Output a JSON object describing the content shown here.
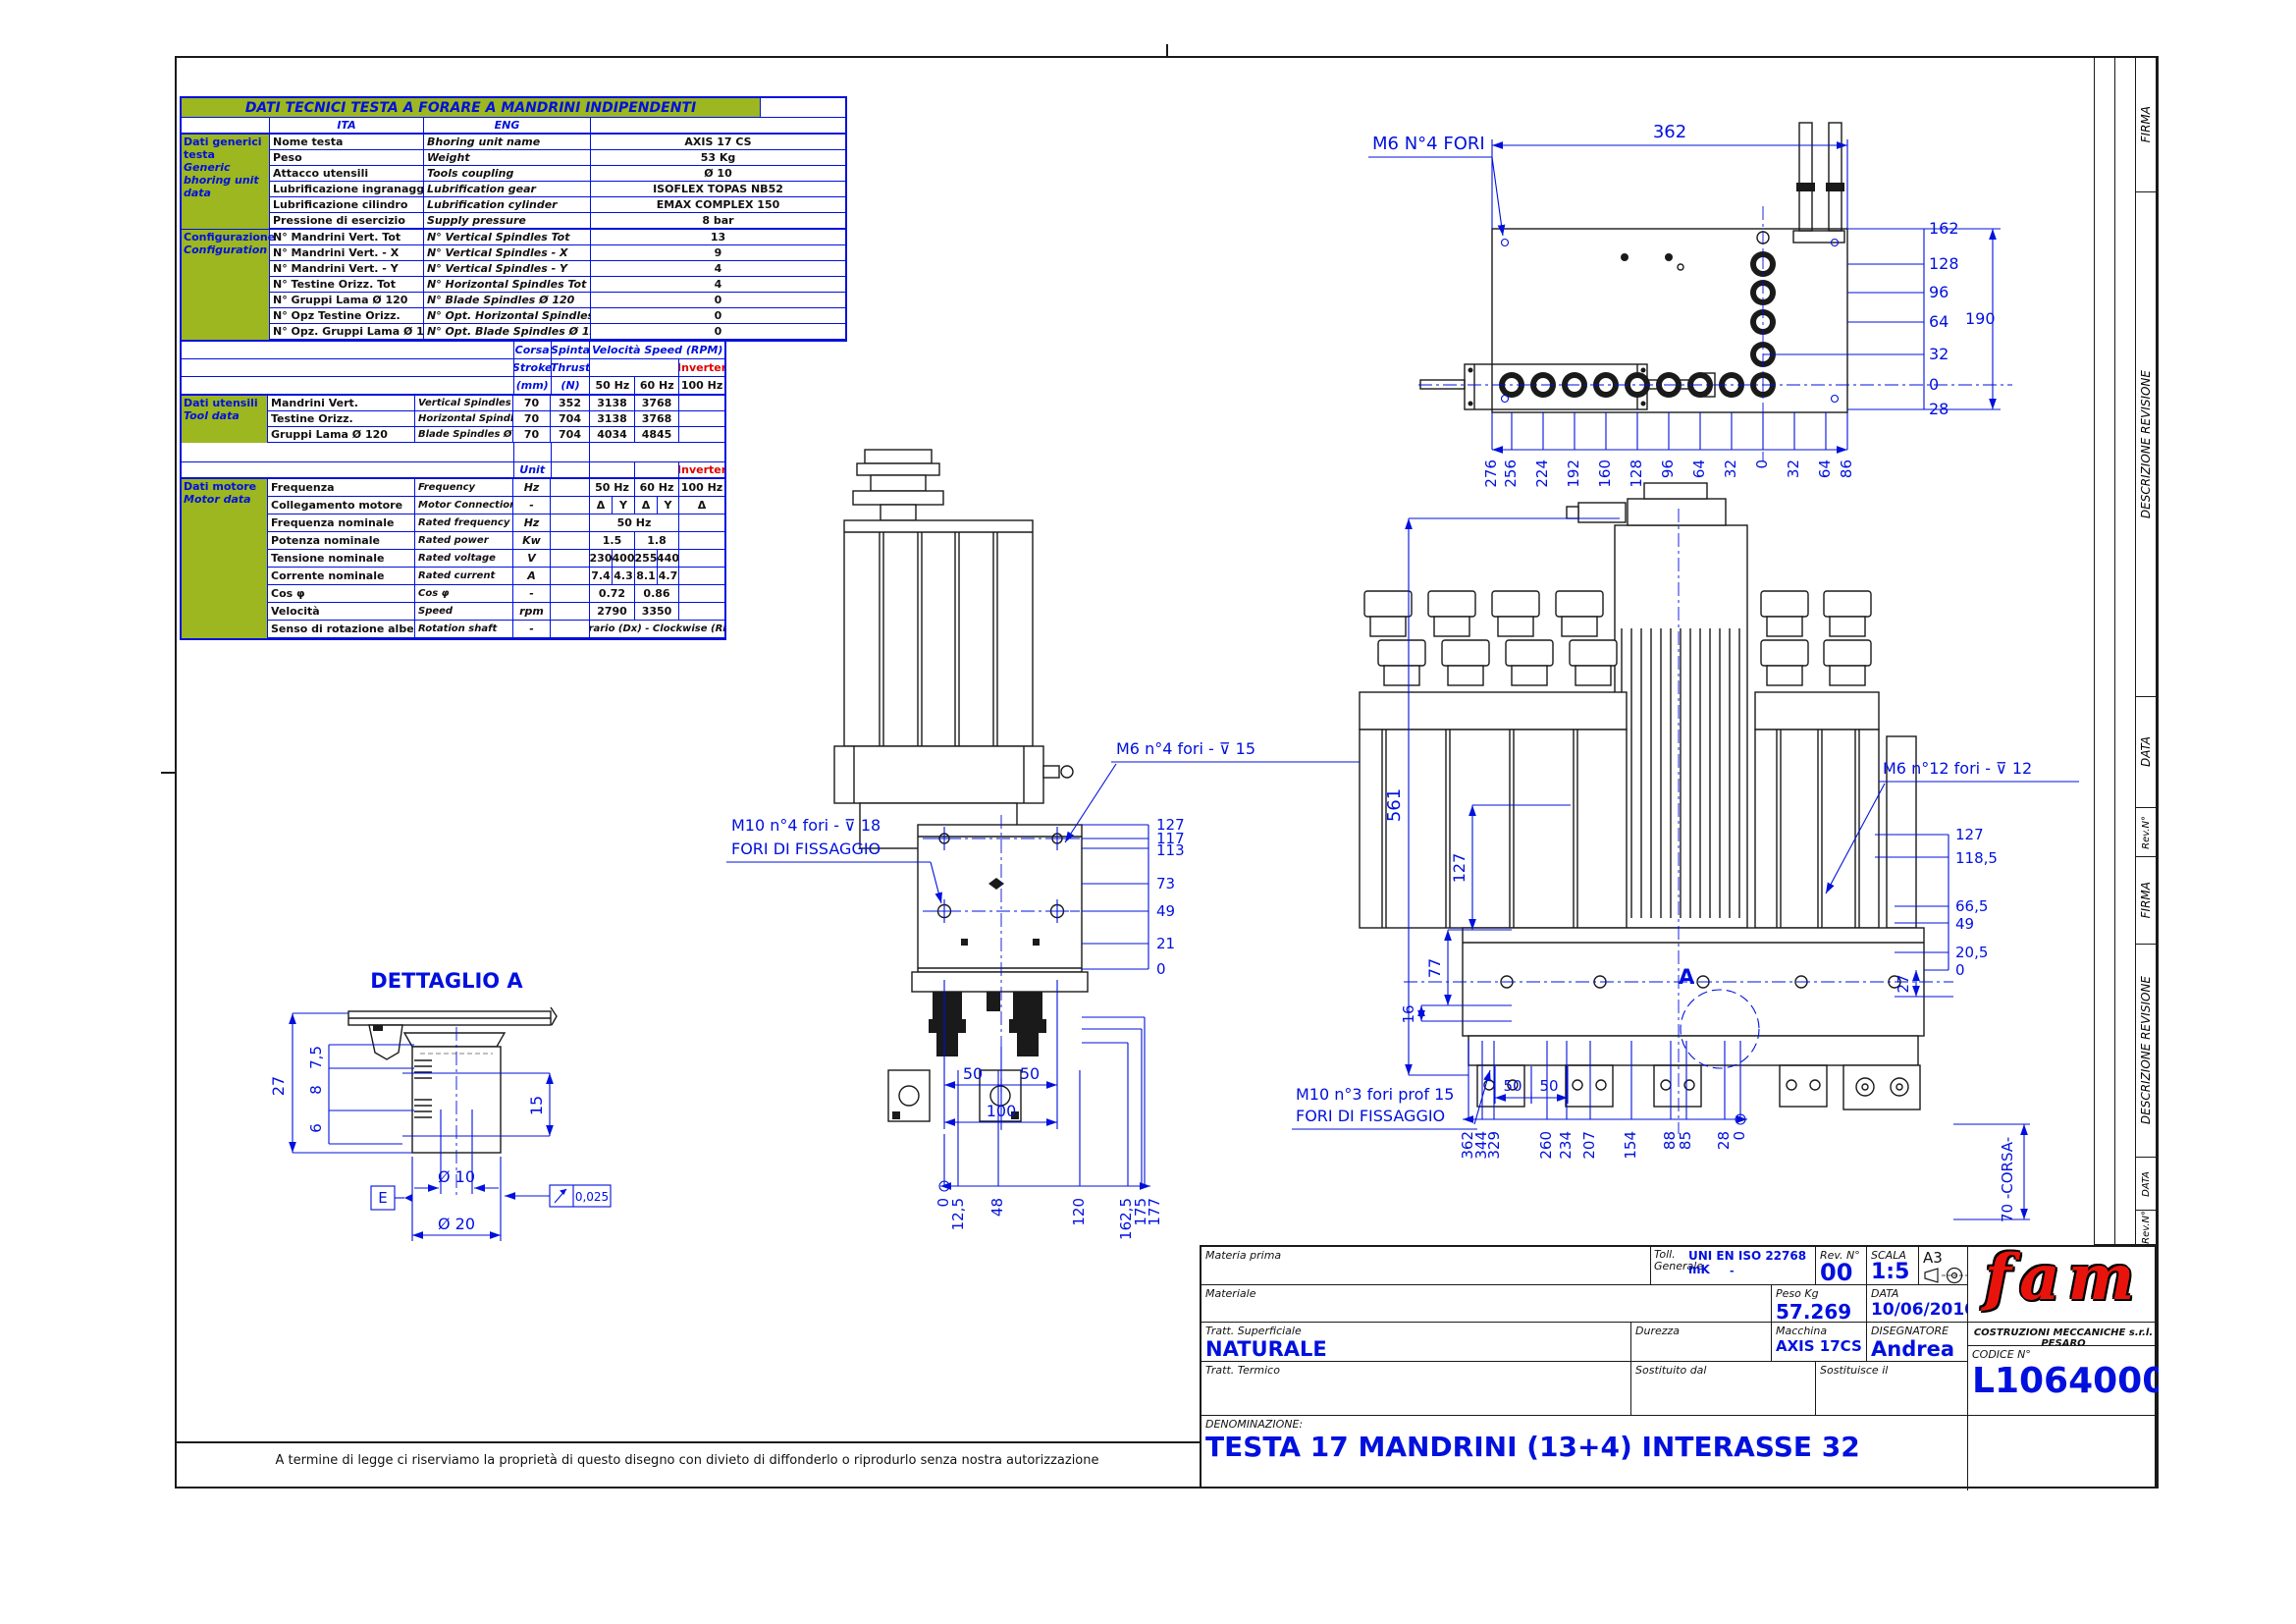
{
  "colors": {
    "line_blue": "#0010dd",
    "table_green": "#9cb71f",
    "logo_red": "#e8140c",
    "black": "#1a1a1a"
  },
  "table": {
    "title": "DATI TECNICI TESTA A FORARE A MANDRINI INDIPENDENTI",
    "col_ita": "ITA",
    "col_eng": "ENG",
    "generic": {
      "group_lines": [
        "Dati generici",
        "testa",
        "Generic",
        "bhoring unit",
        "data"
      ],
      "rows": [
        {
          "ita": "Nome testa",
          "eng": "Bhoring unit name",
          "value": "AXIS 17 CS"
        },
        {
          "ita": "Peso",
          "eng": "Weight",
          "value": "53 Kg"
        },
        {
          "ita": "Attacco utensili",
          "eng": "Tools coupling",
          "value": "Ø 10"
        },
        {
          "ita": "Lubrificazione ingranaggi",
          "eng": "Lubrification gear",
          "value": "ISOFLEX TOPAS NB52"
        },
        {
          "ita": "Lubrificazione cilindro",
          "eng": "Lubrification cylinder",
          "value": "EMAX COMPLEX 150"
        },
        {
          "ita": "Pressione di esercizio",
          "eng": "Supply pressure",
          "value": "8 bar"
        }
      ]
    },
    "configuration": {
      "group_lines": [
        "Configurazione",
        "Configuration"
      ],
      "rows": [
        {
          "ita": "N° Mandrini Vert. Tot",
          "eng": "N° Vertical Spindles Tot",
          "value": "13"
        },
        {
          "ita": "N° Mandrini Vert. - X",
          "eng": "N° Vertical Spindles - X",
          "value": "9"
        },
        {
          "ita": "N° Mandrini Vert. - Y",
          "eng": "N° Vertical Spindles - Y",
          "value": "4"
        },
        {
          "ita": "N° Testine Orizz. Tot",
          "eng": "N° Horizontal Spindles Tot",
          "value": "4"
        },
        {
          "ita": "N° Gruppi Lama Ø 120",
          "eng": "N° Blade Spindles Ø 120",
          "value": "0"
        },
        {
          "ita": "N° Opz Testine Orizz.",
          "eng": "N° Opt. Horizontal Spindles",
          "value": "0"
        },
        {
          "ita": "N° Opz. Gruppi Lama Ø 120",
          "eng": "N° Opt. Blade Spindles Ø 120",
          "value": "0"
        }
      ]
    },
    "speed_header": {
      "corsa": "Corsa",
      "stroke": "Stroke",
      "mm": "(mm)",
      "spinta": "Spinta",
      "thrust": "Thrust",
      "n": "(N)",
      "velocita": "Velocità Speed   (RPM)",
      "inverter": "Inverter",
      "hz50": "50 Hz",
      "hz60": "60 Hz",
      "hz100": "100 Hz"
    },
    "tool": {
      "group_lines": [
        "Dati utensili",
        "Tool data"
      ],
      "rows": [
        {
          "ita": "Mandrini Vert.",
          "eng": "Vertical Spindles",
          "corsa": "70",
          "spinta": "352",
          "hz50": "3138",
          "hz60": "3768",
          "inv": ""
        },
        {
          "ita": "Testine Orizz.",
          "eng": "Horizontal Spindles",
          "corsa": "70",
          "spinta": "704",
          "hz50": "3138",
          "hz60": "3768",
          "inv": ""
        },
        {
          "ita": "Gruppi Lama Ø 120",
          "eng": "Blade Spindles Ø 120",
          "corsa": "70",
          "spinta": "704",
          "hz50": "4034",
          "hz60": "4845",
          "inv": ""
        }
      ]
    },
    "motor": {
      "group_lines": [
        "Dati motore",
        "Motor data"
      ],
      "unit_header": "Unit",
      "inverter": "Inverter",
      "rows": [
        {
          "ita": "Frequenza",
          "eng": "Frequency",
          "unit": "Hz",
          "c1": "50 Hz",
          "c2": "60 Hz",
          "inv": "100 Hz"
        },
        {
          "ita": "Collegamento motore",
          "eng": "Motor Connection",
          "unit": "-",
          "q1": "Δ",
          "q2": "Y",
          "q3": "Δ",
          "q4": "Y",
          "inv": "Δ"
        },
        {
          "ita": "Frequenza nominale",
          "eng": "Rated frequency",
          "unit": "Hz",
          "full": "50 Hz",
          "inv": ""
        },
        {
          "ita": "Potenza nominale",
          "eng": "Rated power",
          "unit": "Kw",
          "c1": "1.5",
          "c2": "1.8",
          "inv": ""
        },
        {
          "ita": "Tensione nominale",
          "eng": "Rated voltage",
          "unit": "V",
          "q1": "230",
          "q2": "400",
          "q3": "255",
          "q4": "440",
          "inv": ""
        },
        {
          "ita": "Corrente nominale",
          "eng": "Rated current",
          "unit": "A",
          "q1": "7.4",
          "q2": "4.3",
          "q3": "8.1",
          "q4": "4.7",
          "inv": ""
        },
        {
          "ita": "Cos φ",
          "eng": "Cos φ",
          "unit": "-",
          "c1": "0.72",
          "c2": "0.86",
          "inv": ""
        },
        {
          "ita": "Velocità",
          "eng": "Speed",
          "unit": "rpm",
          "c1": "2790",
          "c2": "3350",
          "inv": ""
        },
        {
          "ita": "Senso di rotazione albero",
          "eng": "Rotation shaft",
          "unit": "-",
          "wide": "Orario (Dx) - Clockwise (Rh)"
        }
      ]
    }
  },
  "views": {
    "plan": {
      "hole_label": "M6 N°4 FORI",
      "width_dim": "362",
      "height_dim": "190",
      "right_ladder": [
        "162",
        "128",
        "96",
        "64",
        "32",
        "0",
        "28"
      ],
      "bottom_ladder": [
        "276",
        "256",
        "224",
        "192",
        "160",
        "128",
        "96",
        "64",
        "32",
        "0",
        "32",
        "64",
        "86"
      ]
    },
    "front": {
      "m6_label": "M6   n°4 fori - ⊽ 15",
      "m10_label": "M10   n°4 fori - ⊽ 18",
      "fiss_label": "FORI DI FISSAGGIO",
      "right_ladder": [
        "127",
        "117",
        "113",
        "73",
        "49",
        "21",
        "0"
      ],
      "d50a": "50",
      "d50b": "50",
      "d100": "100",
      "bottom_ladder": [
        "0",
        "12,5",
        "48",
        "120",
        "162,5",
        "175",
        "177"
      ]
    },
    "side": {
      "height_dim": "561",
      "left_ladder": [
        "127",
        "77",
        "16"
      ],
      "m6_label": "M6   n°12 fori - ⊽ 12",
      "m10_label": "M10 n°3 fori prof 15",
      "fiss_label": "FORI DI FISSAGGIO",
      "right_ladder": [
        "127",
        "118,5",
        "66,5",
        "49",
        "20,5",
        "0"
      ],
      "d27": "27",
      "detail_mark": "A",
      "d50a": "50",
      "d50b": "50",
      "bottom_ladder": [
        "362",
        "344",
        "329",
        "260",
        "234",
        "207",
        "154",
        "88",
        "85",
        "28",
        "0"
      ],
      "corsa_label": "70  -CORSA-"
    },
    "detail": {
      "title": "DETTAGLIO A",
      "d27": "27",
      "chain": [
        "7,5",
        "8",
        "6"
      ],
      "d15": "15",
      "d10": "Ø 10",
      "d20": "Ø 20",
      "datum": "E",
      "runout": "0,025"
    }
  },
  "titleblock": {
    "materia_prima": "Materia prima",
    "materiale": "Materiale",
    "tratt_sup": "Tratt. Superficiale",
    "tratt_sup_value": "NATURALE",
    "tratt_termico": "Tratt. Termico",
    "toll1": "Toll.",
    "toll2": "Generale",
    "toll_value": "UNI EN ISO 22768 mK",
    "toll_dash": "-",
    "rev_label": "Rev. N°",
    "rev_value": "00",
    "scala_label": "SCALA",
    "scala_value": "1:5",
    "formato": "A3",
    "peso_label": "Peso Kg",
    "peso_value": "57.269 kg",
    "data_label": "DATA",
    "data_value": "10/06/2010",
    "durezza": "Durezza",
    "macchina_label": "Macchina",
    "macchina_value": "AXIS 17CS",
    "disegnatore_label": "DISEGNATORE",
    "disegnatore_value": "Andrea",
    "sost_dal": "Sostituito dal",
    "sost_il": "Sostituisce il",
    "logo": "fam",
    "company": "COSTRUZIONI MECCANICHE s.r.l. PESARO",
    "codice_label": "CODICE N°",
    "codice_value": "L10640001",
    "denom_label": "DENOMINAZIONE:",
    "denom_value": "TESTA 17 MANDRINI (13+4) INTERASSE 32"
  },
  "revision_strip": {
    "labels": [
      "FIRMA",
      "DESCRIZIONE REVISIONE",
      "DATA",
      "Rev.N°",
      "FIRMA",
      "DESCRIZIONE REVISIONE",
      "DATA",
      "Rev.N°"
    ]
  },
  "footer": {
    "disclaimer": "A termine di legge ci riserviamo la proprietà di questo disegno con divieto di diffonderlo o riprodurlo senza nostra autorizzazione"
  }
}
